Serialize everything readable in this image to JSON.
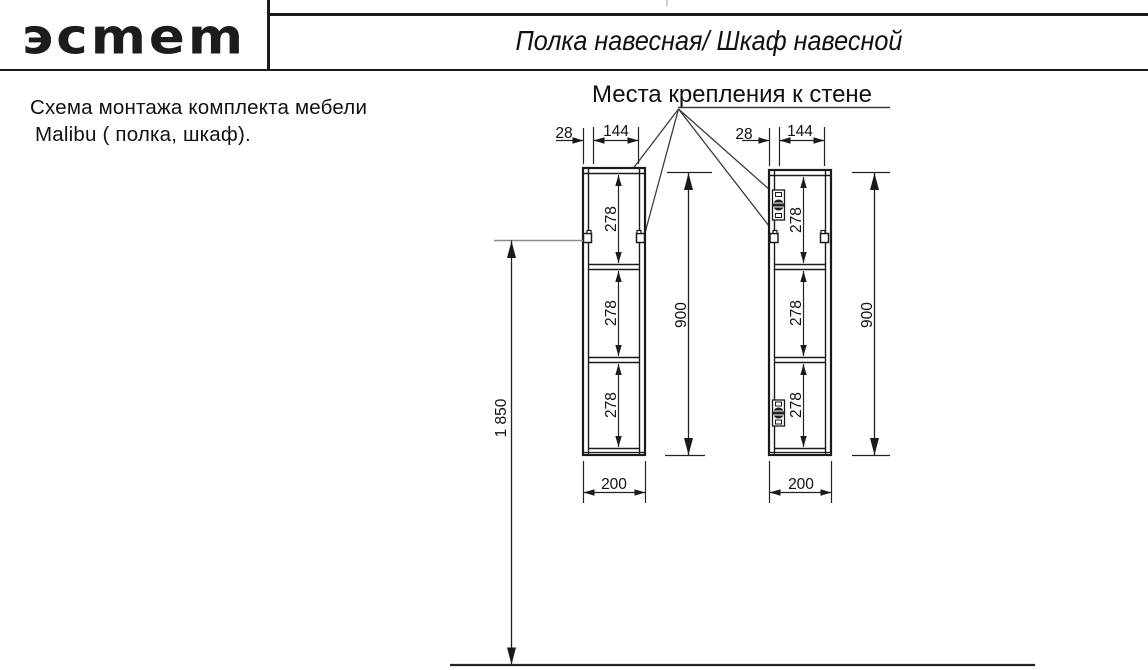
{
  "header": {
    "logo_text": "эcmem",
    "title": "Полка навесная/ Шкаф навесной"
  },
  "note": {
    "line1": "Схема монтажа комплекта мебели",
    "line2": "Malibu ( полка, шкаф)."
  },
  "diagram": {
    "callout_label": "Места крепления к стене",
    "dims": {
      "offset": "28",
      "spacing": "144",
      "section": "278",
      "cabinet_height": "900",
      "cabinet_width": "200",
      "mount_height": "1 850"
    },
    "colors": {
      "line": "#1a1a1a",
      "leader": "#3c3c3c",
      "reference": "#8a8a8a"
    }
  }
}
